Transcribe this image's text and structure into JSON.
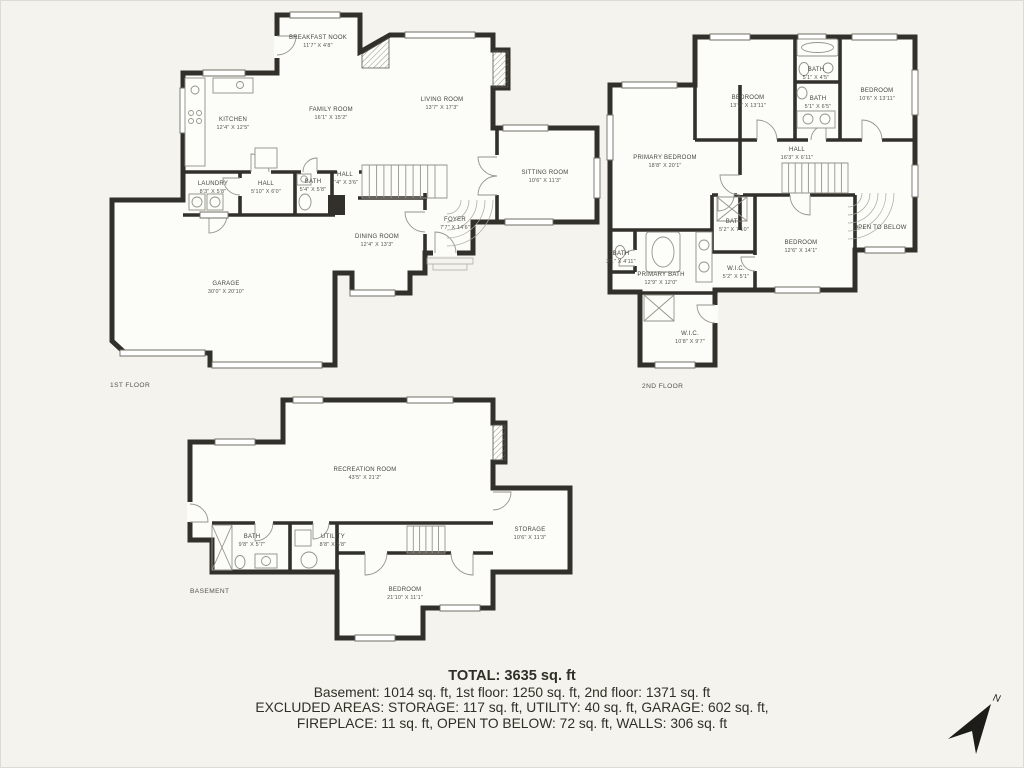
{
  "colors": {
    "background": "#f4f3ed",
    "wall": "#32302a",
    "thin_line": "#95958c",
    "text": "#46463f"
  },
  "floors": {
    "first": {
      "caption": "1ST FLOOR",
      "rooms": {
        "breakfast_nook": {
          "name": "BREAKFAST NOOK",
          "dims": "11'7\" X 4'8\""
        },
        "kitchen": {
          "name": "KITCHEN",
          "dims": "12'4\" X 12'5\""
        },
        "family_room": {
          "name": "FAMILY ROOM",
          "dims": "16'1\" X 15'2\""
        },
        "living_room": {
          "name": "LIVING ROOM",
          "dims": "13'7\" X 17'3\""
        },
        "sitting_room": {
          "name": "SITTING ROOM",
          "dims": "10'6\" X 11'3\""
        },
        "laundry": {
          "name": "LAUNDRY",
          "dims": "8'3\" X 5'8\""
        },
        "hall": {
          "name": "HALL",
          "dims": "5'10\" X 6'0\""
        },
        "bath": {
          "name": "BATH",
          "dims": "5'4\" X 5'8\""
        },
        "hall2": {
          "name": "HALL",
          "dims": "7'4\" X 3'6\""
        },
        "foyer": {
          "name": "FOYER",
          "dims": "7'7\" X 14'6\""
        },
        "dining_room": {
          "name": "DINING ROOM",
          "dims": "12'4\" X 13'3\""
        },
        "garage": {
          "name": "GARAGE",
          "dims": "30'0\" X 20'10\""
        }
      }
    },
    "second": {
      "caption": "2ND FLOOR",
      "rooms": {
        "bedroom_left": {
          "name": "BEDROOM",
          "dims": "13'9\" X 13'11\""
        },
        "bath_top": {
          "name": "BATH",
          "dims": "5'1\" X 4'5\""
        },
        "bath_mid": {
          "name": "BATH",
          "dims": "5'1\" X 6'5\""
        },
        "bedroom_right": {
          "name": "BEDROOM",
          "dims": "10'6\" X 13'11\""
        },
        "primary_bedroom": {
          "name": "PRIMARY BEDROOM",
          "dims": "18'8\" X 20'1\""
        },
        "hall": {
          "name": "HALL",
          "dims": "16'3\" X 6'11\""
        },
        "open_below": {
          "name": "OPEN TO BELOW"
        },
        "bath_52": {
          "name": "BATH",
          "dims": "5'2\" X 7'10\""
        },
        "bath_small": {
          "name": "BATH",
          "dims": "3'1\" X 4'11\""
        },
        "primary_bath": {
          "name": "PRIMARY BATH",
          "dims": "12'9\" X 12'0\""
        },
        "wic_small": {
          "name": "W.I.C.",
          "dims": "5'2\" X 5'1\""
        },
        "bedroom_br": {
          "name": "BEDROOM",
          "dims": "12'6\" X 14'1\""
        },
        "wic_large": {
          "name": "W.I.C.",
          "dims": "10'8\" X 9'7\""
        }
      }
    },
    "basement": {
      "caption": "BASEMENT",
      "rooms": {
        "recreation": {
          "name": "RECREATION ROOM",
          "dims": "43'5\" X 21'2\""
        },
        "bath": {
          "name": "BATH",
          "dims": "9'8\" X 5'7\""
        },
        "utility": {
          "name": "UTILITY",
          "dims": "8'8\" X 5'8\""
        },
        "storage": {
          "name": "STORAGE",
          "dims": "10'6\" X 11'3\""
        },
        "bedroom": {
          "name": "BEDROOM",
          "dims": "21'10\" X 11'1\""
        }
      }
    }
  },
  "summary": {
    "total": "TOTAL: 3635 sq. ft",
    "line1": "Basement: 1014 sq. ft, 1st floor: 1250 sq. ft, 2nd floor: 1371 sq. ft",
    "line2": "EXCLUDED AREAS: STORAGE: 117 sq. ft, UTILITY: 40 sq. ft, GARAGE: 602 sq. ft,",
    "line3": "FIREPLACE: 11 sq. ft, OPEN TO BELOW: 72 sq. ft, WALLS: 306 sq. ft"
  },
  "compass": {
    "label": "N"
  }
}
